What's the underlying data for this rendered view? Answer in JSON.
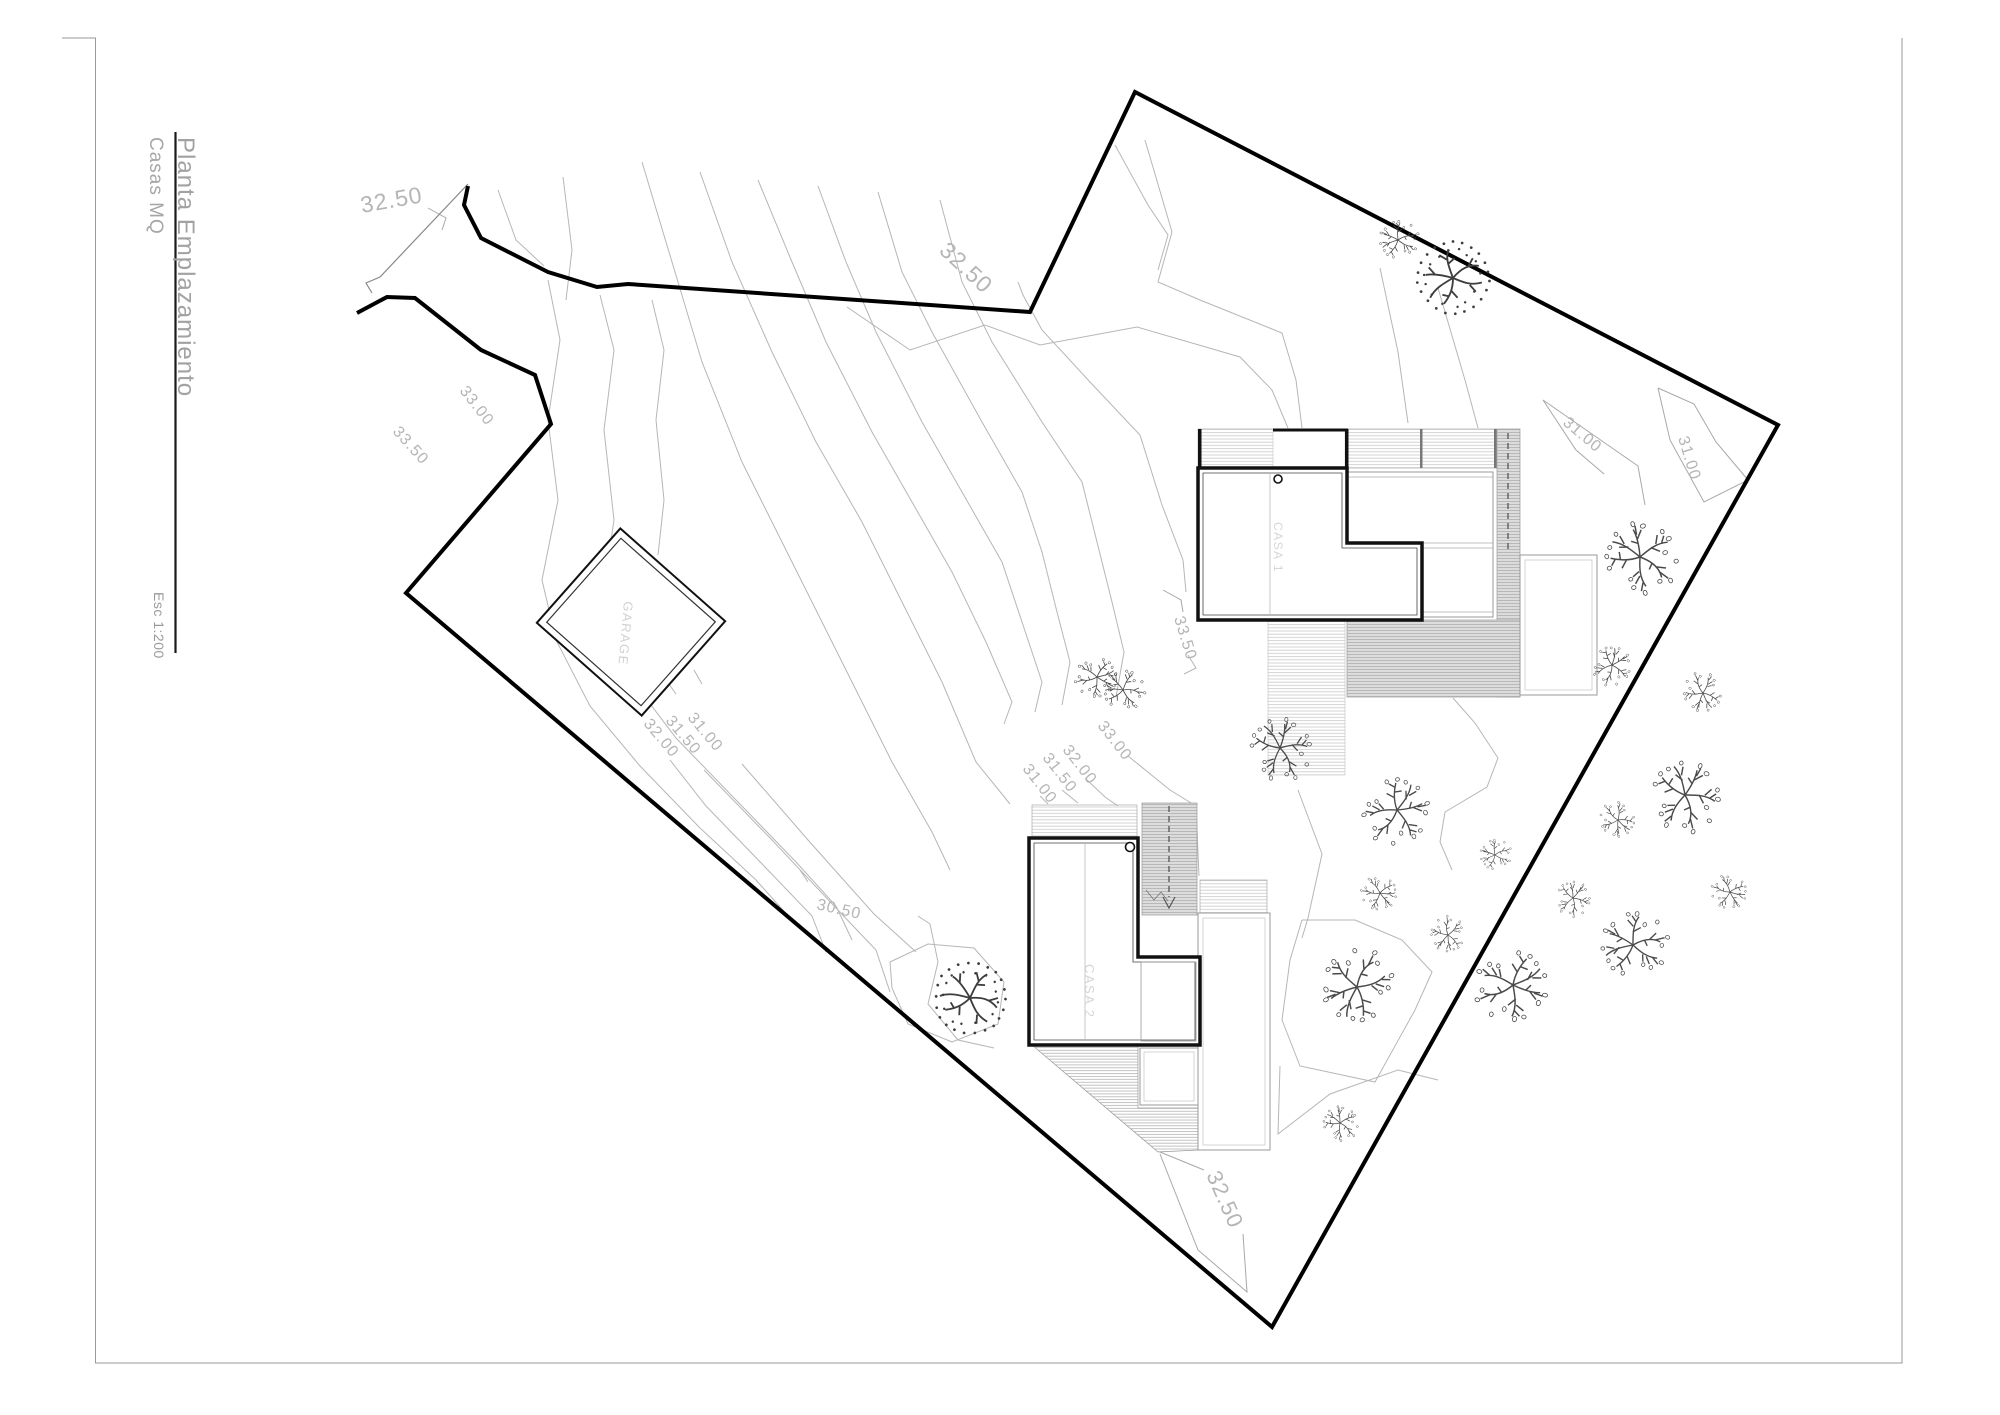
{
  "title_block": {
    "title": "Planta Emplazamiento",
    "subtitle": "Casas MQ",
    "scale": "Esc 1:200"
  },
  "buildings": {
    "casa1_label": "CASA 1",
    "casa2_label": "CASA 2",
    "garage_label": "GARAGE"
  },
  "colors": {
    "boundary": "#000000",
    "contour": "#b6b6b6",
    "leader": "#a8a8a8",
    "label": "#b5b5b5",
    "tree": "#4a4a4a",
    "frame": "#9a9a9a"
  },
  "contour_labels": [
    {
      "t": "32.50",
      "x": 362,
      "y": 213,
      "rot": -10,
      "size": 23
    },
    {
      "t": "32.50",
      "x": 938,
      "y": 252,
      "rot": 43,
      "size": 23
    },
    {
      "t": "33.00",
      "x": 459,
      "y": 391,
      "rot": 52,
      "size": 16
    },
    {
      "t": "33.50",
      "x": 392,
      "y": 432,
      "rot": 48,
      "size": 16
    },
    {
      "t": "32.00",
      "x": 643,
      "y": 724,
      "rot": 50,
      "size": 16
    },
    {
      "t": "31.50",
      "x": 665,
      "y": 721,
      "rot": 50,
      "size": 16
    },
    {
      "t": "31.00",
      "x": 687,
      "y": 718,
      "rot": 50,
      "size": 16
    },
    {
      "t": "30.50",
      "x": 816,
      "y": 909,
      "rot": 13,
      "size": 16
    },
    {
      "t": "31.00",
      "x": 1022,
      "y": 769,
      "rot": 52,
      "size": 16
    },
    {
      "t": "31.50",
      "x": 1042,
      "y": 758,
      "rot": 52,
      "size": 16
    },
    {
      "t": "32.00",
      "x": 1062,
      "y": 750,
      "rot": 52,
      "size": 16
    },
    {
      "t": "33.00",
      "x": 1097,
      "y": 726,
      "rot": 52,
      "size": 16
    },
    {
      "t": "33.50",
      "x": 1174,
      "y": 618,
      "rot": 73,
      "size": 16
    },
    {
      "t": "31.00",
      "x": 1562,
      "y": 424,
      "rot": 40,
      "size": 16
    },
    {
      "t": "31.00",
      "x": 1678,
      "y": 438,
      "rot": 73,
      "size": 16
    },
    {
      "t": "32.50",
      "x": 1206,
      "y": 1175,
      "rot": 66,
      "size": 22
    }
  ],
  "site": {
    "boundary": [
      [
        468,
        186
      ],
      [
        464,
        205
      ],
      [
        481,
        238
      ],
      [
        548,
        272
      ],
      [
        597,
        287
      ],
      [
        628,
        284
      ],
      [
        1030,
        312
      ],
      [
        1135,
        92
      ],
      [
        1778,
        425
      ],
      [
        1272,
        1327
      ],
      [
        406,
        593
      ],
      [
        551,
        424
      ],
      [
        535,
        375
      ],
      [
        481,
        350
      ],
      [
        415,
        298
      ],
      [
        387,
        297
      ],
      [
        357,
        313
      ]
    ],
    "entrance_line": [
      [
        468,
        184
      ],
      [
        380,
        277
      ],
      [
        366,
        283
      ],
      [
        372,
        293
      ]
    ]
  },
  "contours": [
    [
      [
        1018,
        282
      ],
      [
        1023,
        295
      ],
      [
        1042,
        330
      ],
      [
        1090,
        382
      ],
      [
        1140,
        435
      ],
      [
        1162,
        505
      ],
      [
        1183,
        560
      ],
      [
        1186,
        592
      ]
    ],
    [
      [
        1188,
        655
      ],
      [
        1196,
        668
      ],
      [
        1184,
        674
      ]
    ],
    [
      [
        940,
        200
      ],
      [
        962,
        282
      ],
      [
        992,
        342
      ],
      [
        1042,
        422
      ],
      [
        1082,
        482
      ],
      [
        1097,
        542
      ],
      [
        1112,
        602
      ],
      [
        1124,
        652
      ],
      [
        1116,
        697
      ]
    ],
    [
      [
        1128,
        756
      ],
      [
        1170,
        790
      ],
      [
        1196,
        806
      ],
      [
        1199,
        876
      ]
    ],
    [
      [
        878,
        192
      ],
      [
        902,
        272
      ],
      [
        932,
        332
      ],
      [
        982,
        422
      ],
      [
        1022,
        492
      ],
      [
        1042,
        552
      ],
      [
        1057,
        612
      ],
      [
        1070,
        662
      ],
      [
        1062,
        705
      ]
    ],
    [
      [
        1085,
        778
      ],
      [
        1105,
        797
      ],
      [
        1118,
        806
      ]
    ],
    [
      [
        818,
        186
      ],
      [
        846,
        262
      ],
      [
        876,
        332
      ],
      [
        922,
        422
      ],
      [
        962,
        492
      ],
      [
        1002,
        562
      ],
      [
        1022,
        622
      ],
      [
        1042,
        682
      ],
      [
        1035,
        712
      ]
    ],
    [
      [
        1062,
        790
      ],
      [
        1078,
        803
      ]
    ],
    [
      [
        758,
        180
      ],
      [
        792,
        262
      ],
      [
        826,
        342
      ],
      [
        872,
        432
      ],
      [
        912,
        502
      ],
      [
        952,
        572
      ],
      [
        986,
        642
      ],
      [
        1012,
        702
      ],
      [
        1004,
        724
      ]
    ],
    [
      [
        1040,
        796
      ],
      [
        1048,
        804
      ]
    ],
    [
      [
        700,
        172
      ],
      [
        732,
        262
      ],
      [
        772,
        352
      ],
      [
        816,
        442
      ],
      [
        862,
        522
      ],
      [
        902,
        602
      ],
      [
        942,
        682
      ],
      [
        976,
        762
      ],
      [
        1010,
        804
      ]
    ],
    [
      [
        642,
        162
      ],
      [
        672,
        262
      ],
      [
        702,
        362
      ],
      [
        742,
        462
      ],
      [
        792,
        562
      ],
      [
        842,
        662
      ],
      [
        892,
        762
      ],
      [
        932,
        832
      ],
      [
        950,
        870
      ]
    ],
    [
      [
        548,
        280
      ],
      [
        560,
        340
      ],
      [
        548,
        420
      ],
      [
        558,
        500
      ],
      [
        542,
        580
      ],
      [
        556,
        640
      ],
      [
        590,
        706
      ],
      [
        640,
        766
      ],
      [
        700,
        828
      ],
      [
        756,
        880
      ],
      [
        790,
        918
      ]
    ],
    [
      [
        600,
        295
      ],
      [
        614,
        350
      ],
      [
        604,
        430
      ],
      [
        614,
        520
      ],
      [
        602,
        600
      ],
      [
        626,
        672
      ],
      [
        676,
        738
      ],
      [
        736,
        800
      ],
      [
        796,
        862
      ],
      [
        836,
        906
      ],
      [
        852,
        940
      ]
    ],
    [
      [
        652,
        300
      ],
      [
        664,
        350
      ],
      [
        656,
        420
      ],
      [
        664,
        500
      ],
      [
        658,
        555
      ]
    ],
    [
      [
        638,
        690
      ],
      [
        648,
        701
      ]
    ],
    [
      [
        670,
        760
      ],
      [
        706,
        806
      ],
      [
        766,
        868
      ],
      [
        812,
        916
      ],
      [
        826,
        952
      ]
    ],
    [
      [
        666,
        680
      ],
      [
        676,
        694
      ]
    ],
    [
      [
        704,
        770
      ],
      [
        772,
        840
      ],
      [
        836,
        908
      ],
      [
        876,
        950
      ],
      [
        890,
        992
      ]
    ],
    [
      [
        694,
        670
      ],
      [
        702,
        684
      ]
    ],
    [
      [
        742,
        764
      ],
      [
        808,
        840
      ],
      [
        874,
        914
      ],
      [
        916,
        952
      ]
    ],
    [
      [
        800,
        870
      ],
      [
        808,
        882
      ]
    ],
    [
      [
        918,
        916
      ],
      [
        930,
        924
      ],
      [
        938,
        962
      ],
      [
        928,
        1004
      ],
      [
        958,
        1040
      ],
      [
        994,
        1048
      ]
    ],
    [
      [
        890,
        962
      ],
      [
        928,
        944
      ],
      [
        974,
        948
      ],
      [
        1004,
        982
      ],
      [
        998,
        1024
      ],
      [
        952,
        1042
      ],
      [
        908,
        1024
      ],
      [
        892,
        988
      ],
      [
        890,
        962
      ]
    ],
    [
      [
        1145,
        140
      ],
      [
        1172,
        232
      ],
      [
        1158,
        282
      ],
      [
        1200,
        300
      ],
      [
        1282,
        333
      ],
      [
        1296,
        380
      ],
      [
        1302,
        428
      ]
    ],
    [
      [
        1380,
        268
      ],
      [
        1398,
        352
      ],
      [
        1408,
        423
      ]
    ],
    [
      [
        1438,
        288
      ],
      [
        1465,
        380
      ],
      [
        1478,
        428
      ]
    ],
    [
      [
        847,
        307
      ],
      [
        910,
        350
      ],
      [
        985,
        325
      ],
      [
        1040,
        345
      ],
      [
        1137,
        327
      ],
      [
        1240,
        357
      ],
      [
        1272,
        390
      ],
      [
        1288,
        428
      ]
    ],
    [
      [
        498,
        190
      ],
      [
        516,
        240
      ],
      [
        544,
        266
      ]
    ],
    [
      [
        563,
        177
      ],
      [
        572,
        250
      ],
      [
        566,
        300
      ]
    ],
    [
      [
        1115,
        145
      ],
      [
        1148,
        205
      ],
      [
        1168,
        235
      ],
      [
        1158,
        270
      ]
    ],
    [
      [
        1298,
        790
      ],
      [
        1322,
        854
      ],
      [
        1308,
        918
      ],
      [
        1302,
        938
      ]
    ],
    [
      [
        1302,
        920
      ],
      [
        1355,
        920
      ],
      [
        1402,
        940
      ],
      [
        1432,
        972
      ],
      [
        1415,
        1010
      ],
      [
        1375,
        1082
      ],
      [
        1300,
        1066
      ],
      [
        1282,
        1020
      ],
      [
        1290,
        960
      ],
      [
        1302,
        920
      ]
    ],
    [
      [
        1280,
        1066
      ],
      [
        1278,
        1134
      ],
      [
        1330,
        1094
      ],
      [
        1398,
        1070
      ],
      [
        1438,
        1080
      ]
    ],
    [
      [
        1453,
        698
      ],
      [
        1475,
        723
      ],
      [
        1498,
        758
      ],
      [
        1487,
        787
      ],
      [
        1445,
        812
      ],
      [
        1440,
        842
      ],
      [
        1452,
        870
      ]
    ]
  ],
  "leaders": [
    [
      [
        428,
        208
      ],
      [
        446,
        218
      ],
      [
        442,
        230
      ]
    ],
    [
      [
        1163,
        590
      ],
      [
        1181,
        600
      ],
      [
        1183,
        612
      ]
    ],
    [
      [
        1543,
        400
      ],
      [
        1638,
        466
      ],
      [
        1645,
        505
      ]
    ],
    [
      [
        1543,
        400
      ],
      [
        1576,
        450
      ],
      [
        1604,
        474
      ]
    ],
    [
      [
        1658,
        388
      ],
      [
        1670,
        440
      ],
      [
        1704,
        502
      ],
      [
        1748,
        480
      ],
      [
        1716,
        442
      ],
      [
        1694,
        404
      ],
      [
        1658,
        388
      ]
    ],
    [
      [
        1160,
        1152
      ],
      [
        1204,
        1170
      ]
    ],
    [
      [
        1243,
        1234
      ],
      [
        1247,
        1292
      ],
      [
        1198,
        1250
      ],
      [
        1160,
        1154
      ]
    ]
  ],
  "trees": [
    {
      "s": "A",
      "x": 1398,
      "y": 240,
      "r": 20,
      "a": 15
    },
    {
      "s": "B",
      "x": 1453,
      "y": 278,
      "r": 38,
      "a": 0
    },
    {
      "s": "A",
      "x": 1640,
      "y": 557,
      "r": 37,
      "a": 70
    },
    {
      "s": "A",
      "x": 1612,
      "y": 665,
      "r": 20,
      "a": 140
    },
    {
      "s": "A",
      "x": 1097,
      "y": 677,
      "r": 21,
      "a": 200
    },
    {
      "s": "A",
      "x": 1123,
      "y": 690,
      "r": 21,
      "a": 40
    },
    {
      "s": "A",
      "x": 1280,
      "y": 748,
      "r": 32,
      "a": 95
    },
    {
      "s": "A",
      "x": 1397,
      "y": 810,
      "r": 34,
      "a": 160
    },
    {
      "s": "A",
      "x": 1380,
      "y": 893,
      "r": 18,
      "a": 220
    },
    {
      "s": "A",
      "x": 1448,
      "y": 935,
      "r": 18,
      "a": 300
    },
    {
      "s": "A",
      "x": 1495,
      "y": 855,
      "r": 16,
      "a": 10
    },
    {
      "s": "A",
      "x": 1573,
      "y": 898,
      "r": 18,
      "a": 120
    },
    {
      "s": "A",
      "x": 1618,
      "y": 820,
      "r": 18,
      "a": 260
    },
    {
      "s": "A",
      "x": 1357,
      "y": 987,
      "r": 37,
      "a": 330
    },
    {
      "s": "A",
      "x": 1340,
      "y": 1123,
      "r": 18,
      "a": 75
    },
    {
      "s": "A",
      "x": 1513,
      "y": 985,
      "r": 37,
      "a": 190
    },
    {
      "s": "B",
      "x": 970,
      "y": 998,
      "r": 38,
      "a": 45
    },
    {
      "s": "A",
      "x": 1703,
      "y": 693,
      "r": 20,
      "a": 280
    },
    {
      "s": "A",
      "x": 1685,
      "y": 795,
      "r": 36,
      "a": 110
    },
    {
      "s": "A",
      "x": 1633,
      "y": 945,
      "r": 34,
      "a": 20
    },
    {
      "s": "A",
      "x": 1730,
      "y": 892,
      "r": 18,
      "a": 230
    }
  ]
}
